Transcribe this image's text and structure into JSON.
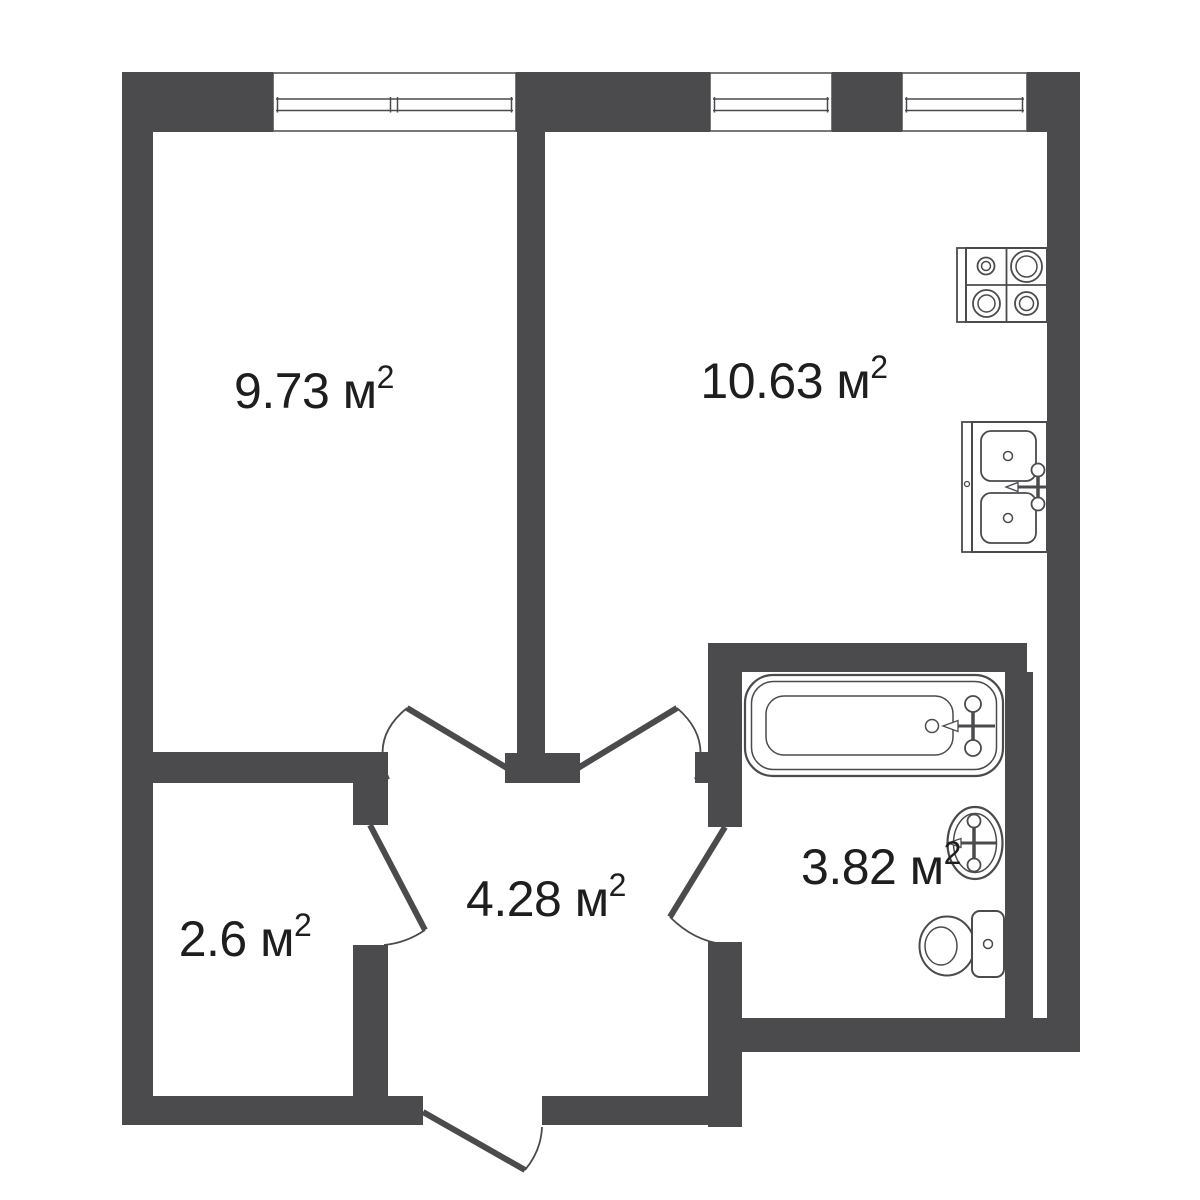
{
  "plan": {
    "background_color": "#ffffff",
    "wall_color": "#4b4b4d",
    "line_color": "#4b4b4d",
    "text_color": "#1e1e1e",
    "rooms": [
      {
        "id": "top-left-room",
        "area_m2": 9.73,
        "label_base": "9.73 м",
        "label_sup": "2",
        "label_full": "9.73 м²"
      },
      {
        "id": "kitchen",
        "area_m2": 10.63,
        "label_base": "10.63 м",
        "label_sup": "2",
        "label_full": "10.63 м²"
      },
      {
        "id": "hallway",
        "area_m2": 4.28,
        "label_base": "4.28 м",
        "label_sup": "2",
        "label_full": "4.28 м²"
      },
      {
        "id": "storage",
        "area_m2": 2.6,
        "label_base": "2.6 м",
        "label_sup": "2",
        "label_full": "2.6 м²"
      },
      {
        "id": "bathroom",
        "area_m2": 3.82,
        "label_base": "3.82 м",
        "label_sup": "2",
        "label_full": "3.82 м²"
      }
    ],
    "fixtures": [
      "stove",
      "kitchen-sink",
      "bathtub",
      "washbasin",
      "toilet"
    ],
    "windows_count": 3,
    "doors_count": 5
  }
}
